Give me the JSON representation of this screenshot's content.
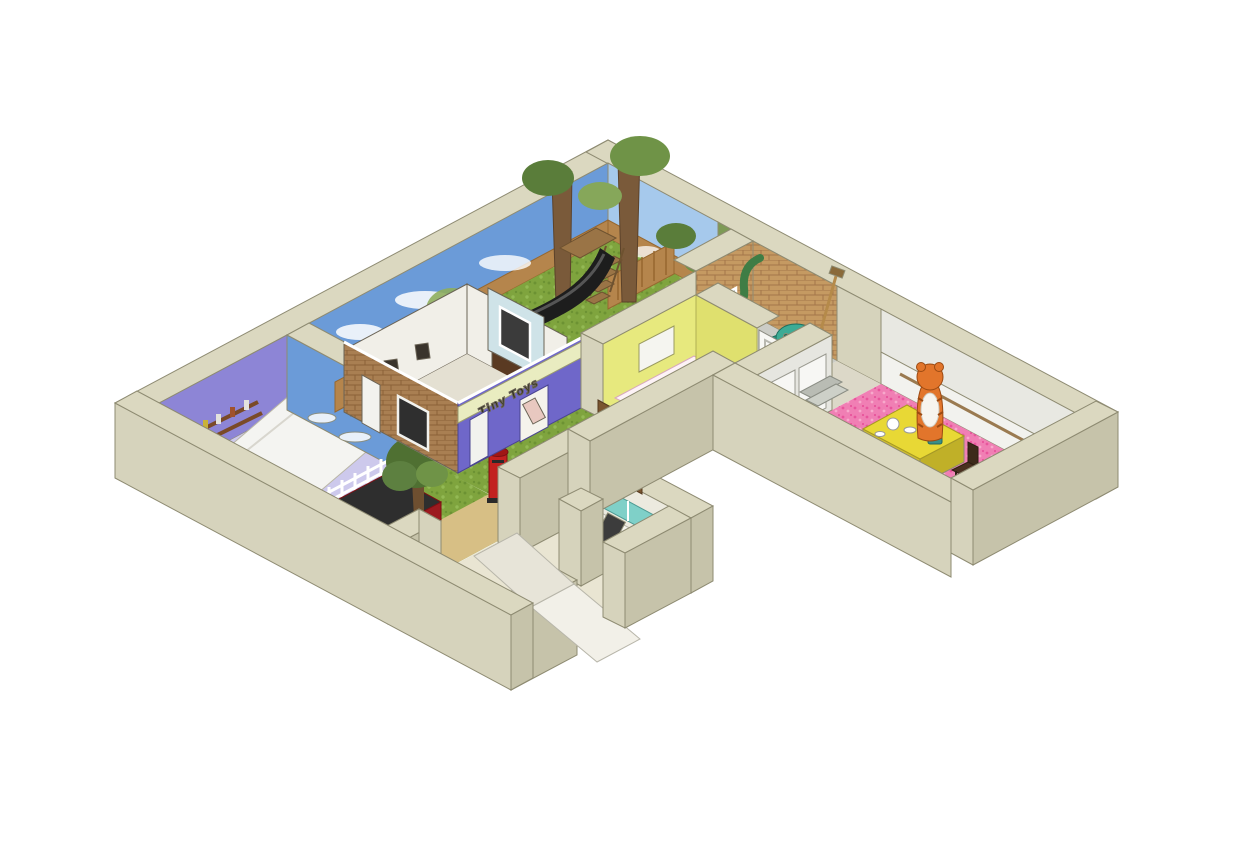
{
  "figure": {
    "type": "isometric-cutaway-floorplan",
    "background": "#ffffff",
    "description": "3D cutaway dollhouse-style model of an exhibition floor with themed children's story rooms, viewed isometrically from above"
  },
  "shop_sign": {
    "label": "Tiny Toys"
  },
  "palette": {
    "wall_top": "#dbd8c0",
    "wall_sw": "#d6d3bc",
    "wall_se": "#c6c3aa",
    "wall_edge": "#8e8b72",
    "sky": "#6b9bd8",
    "sky_light": "#a6c9ec",
    "grass": "#7fa43e",
    "sand": "#d7bf85",
    "brick": "#a97f52",
    "brick_light": "#c59a62",
    "purple_wall": "#8d85d6",
    "shop_purple": "#6f67c9",
    "sign_bg": "#e9ecc0",
    "teal_floor": "#1fa3a3",
    "pink_floor": "#f07fb4",
    "yellow_wall": "#e7e97e",
    "wood": "#b5854c",
    "post_red": "#c2211f",
    "truck_red": "#b31f24",
    "tiger_orange": "#e2752b",
    "table_yellow": "#e8d835",
    "armchair_teal": "#2f9a85",
    "kitchen_teal": "#7fd0c8",
    "floor_pale": "#e9e5d2",
    "grey_floor": "#cbccc6",
    "bush_green": "#234f23",
    "stair_slate": "#46606b",
    "door_white": "#f7f7f4",
    "slide_black": "#1d1d1d"
  },
  "rooms": [
    {
      "name": "garden-play-area",
      "floor": "grass",
      "features": [
        "sky-mural-walls",
        "wooden-fence",
        "tree-trunk-stairs",
        "black-slide",
        "shed"
      ]
    },
    {
      "name": "purple-performance-room",
      "floor": "white-ramp",
      "features": [
        "purple-walls",
        "prop-shelf"
      ]
    },
    {
      "name": "front-yard",
      "floor": "grass-and-sand-path",
      "features": [
        "white-picket-fence",
        "tree",
        "red-truck",
        "red-post-box"
      ]
    },
    {
      "name": "brick-house-with-toy-shop",
      "floor": "pale",
      "features": [
        "brick-facade",
        "purple-shopfront",
        "sign-band",
        "windows"
      ]
    },
    {
      "name": "teal-floor-room",
      "floor": "teal-carpet",
      "features": [
        "yellow-walls",
        "polka-dot-bed",
        "arched-cat-hole",
        "white-door"
      ]
    },
    {
      "name": "grey-floor-room",
      "floor": "grey",
      "features": [
        "brick-wall-window",
        "green-drainpipe",
        "spotted-armchair",
        "broom",
        "milk-bottle"
      ]
    },
    {
      "name": "kitchen-entrance",
      "floor": "pale",
      "features": [
        "teal-cabinets",
        "appliances",
        "entry-ramp",
        "shelf-unit"
      ]
    },
    {
      "name": "tiger-tea-room",
      "floor": "pink-carpet",
      "features": [
        "tiger-figure",
        "yellow-tea-table",
        "chairs",
        "wainscot-walls",
        "bush",
        "dark-stair"
      ]
    }
  ],
  "objects": [
    "tiger-figure",
    "tea-table",
    "post-box",
    "red-truck",
    "slide",
    "tree-trunks",
    "staircase",
    "picket-fence",
    "wooden-fence",
    "armchair",
    "beanbag",
    "kitchen-cabinets",
    "door-leaf",
    "ramp"
  ]
}
